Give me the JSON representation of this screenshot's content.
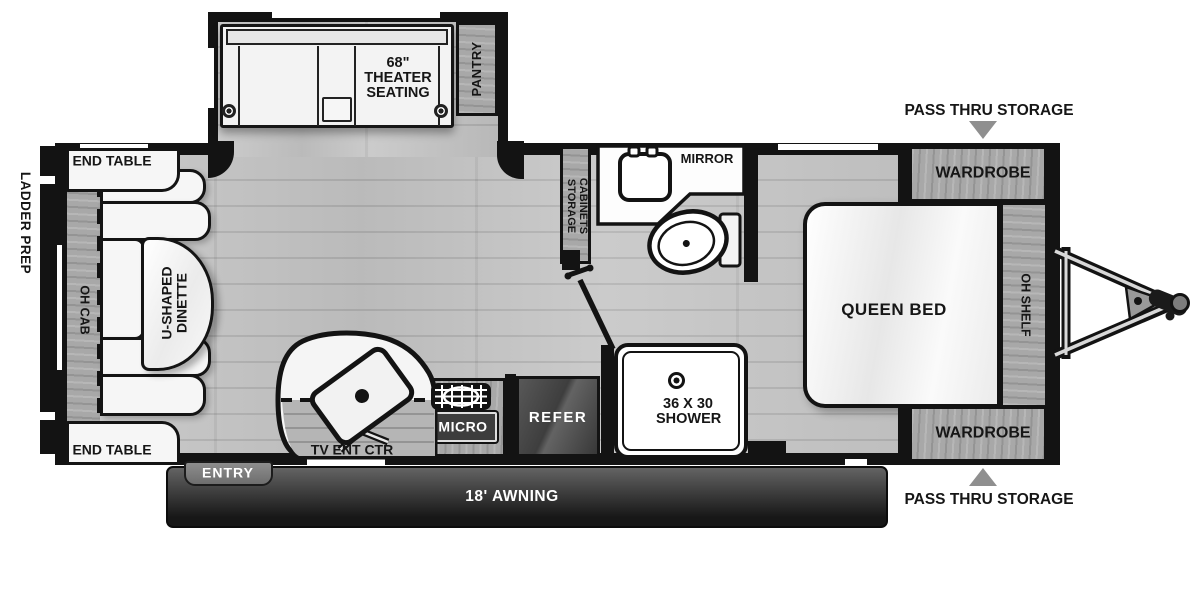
{
  "colors": {
    "wall": "#131313",
    "floor": "#c6c6c6",
    "cabinet_wood": "#a8a8a8",
    "fixture_white": "#f6f6f6",
    "appliance_dark": "#444444",
    "awning_dark": "#1e1e1e",
    "arrow_gray": "#8f8f8f"
  },
  "exterior": {
    "ladder_prep": "LADDER PREP",
    "pass_thru_top": "PASS THRU STORAGE",
    "pass_thru_bottom": "PASS THRU STORAGE",
    "awning": "18' AWNING",
    "entry": "ENTRY"
  },
  "slideout": {
    "theater": "68\" THEATER SEATING",
    "pantry": "PANTRY"
  },
  "living": {
    "end_table_top": "END TABLE",
    "end_table_bottom": "END TABLE",
    "oh_cab": "OH CAB",
    "dinette": "U-SHAPED DINETTE",
    "tv": "TV ENT CTR"
  },
  "kitchen": {
    "micro": "MICRO",
    "refer": "REFER"
  },
  "bath": {
    "storage_line1": "STORAGE",
    "storage_line2": "CABINETS",
    "mirror": "MIRROR",
    "shower": "36 X 30 SHOWER"
  },
  "bedroom": {
    "queen_bed": "QUEEN BED",
    "wardrobe_top": "WARDROBE",
    "wardrobe_bottom": "WARDROBE",
    "oh_shelf": "OH SHELF"
  }
}
